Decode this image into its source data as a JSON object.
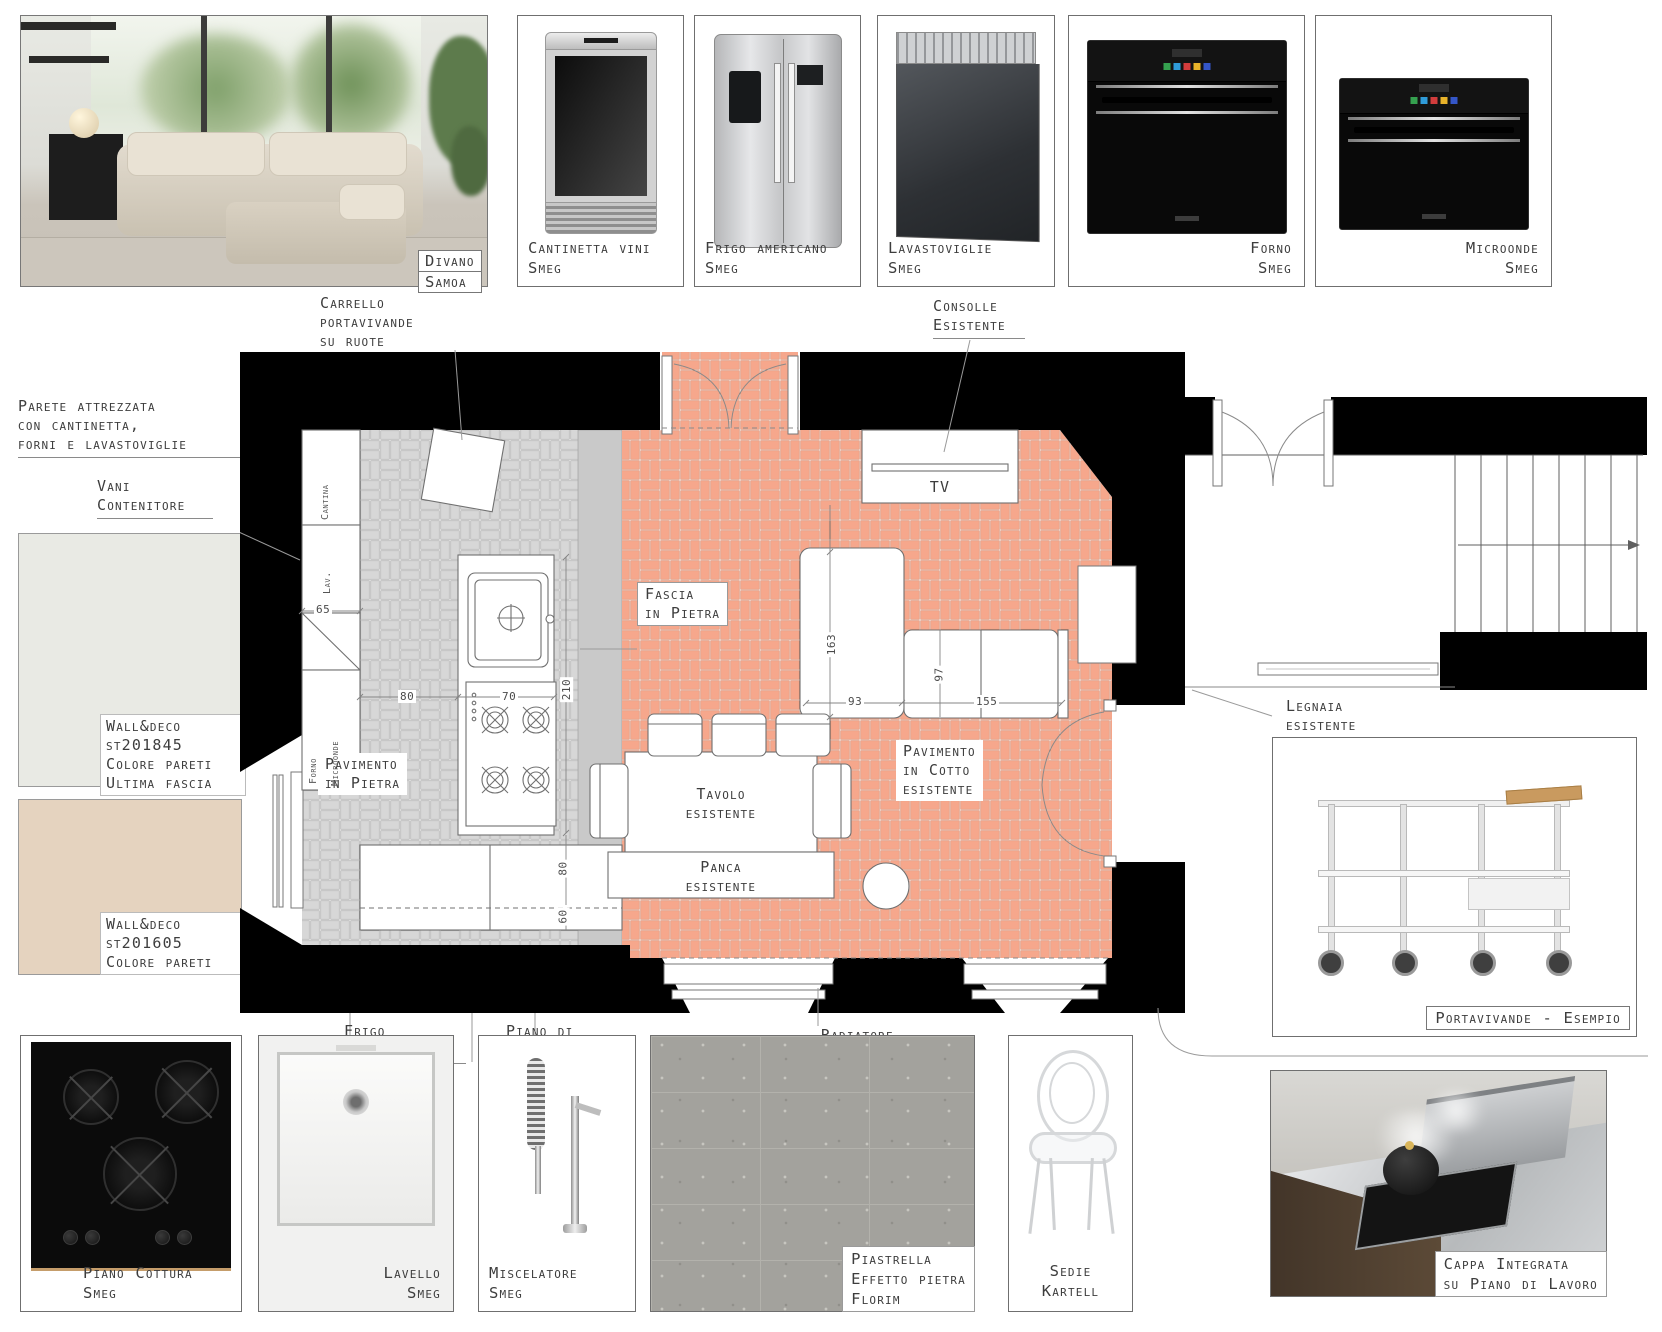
{
  "top_row": {
    "sofa_label": [
      "Divano",
      "Samoa"
    ],
    "products": [
      {
        "label": "Cantinetta vini",
        "brand": "Smeg"
      },
      {
        "label": "Frigo americano",
        "brand": "Smeg"
      },
      {
        "label": "Lavastoviglie",
        "brand": "Smeg"
      },
      {
        "label": "Forno",
        "brand": "Smeg"
      },
      {
        "label": "Microonde",
        "brand": "Smeg"
      }
    ]
  },
  "annotations": {
    "carrello": [
      "Carrello",
      "portavivande",
      "su ruote"
    ],
    "consolle": [
      "Consolle",
      "Esistente"
    ],
    "parete": [
      "Parete attrezzata",
      "con cantinetta,",
      "forni e lavastoviglie"
    ],
    "vani": [
      "Vani",
      "Contenitore"
    ],
    "legnaia": [
      "Legnaia",
      "esistente"
    ],
    "mensole": "Mensole",
    "frigo_americano": [
      "Frigo",
      "Americano"
    ],
    "piano_lavoro": [
      "Piano di",
      "lavoro con",
      "affettatrice"
    ],
    "radiatore": "Radiatore"
  },
  "swatches": [
    {
      "color": "#e9eae4",
      "lines": [
        "Wall&deco",
        "st201845",
        "Colore pareti",
        "Ultima fascia"
      ]
    },
    {
      "color": "#e5d3bf",
      "lines": [
        "Wall&deco",
        "st201605",
        "Colore pareti"
      ]
    }
  ],
  "plan": {
    "labels": {
      "tv": "TV",
      "fascia": [
        "Fascia",
        "in Pietra"
      ],
      "pavimento_pietra": [
        "Pavimento",
        "in Pietra"
      ],
      "pavimento_cotto": [
        "Pavimento",
        "in Cotto",
        "esistente"
      ],
      "tavolo": [
        "Tavolo",
        "esistente"
      ],
      "panca": [
        "Panca",
        "esistente"
      ]
    },
    "units": [
      "Cantina",
      "Lav.",
      "Forno",
      "Microonde"
    ],
    "dims": {
      "d65": "65",
      "d80": "80",
      "d70": "70",
      "d210": "210",
      "d163": "163",
      "d93": "93",
      "d97": "97",
      "d155": "155",
      "d80b": "80",
      "d60": "60"
    }
  },
  "portavivande": {
    "label": "Portavivande - Esempio"
  },
  "bottom_row": {
    "piano_cottura": [
      "Piano Cottura",
      "Smeg"
    ],
    "lavello": [
      "Lavello",
      "Smeg"
    ],
    "miscelatore": [
      "Miscelatore",
      "Smeg"
    ],
    "piastrella": [
      "Piastrella",
      "Effetto pietra",
      "Florim"
    ],
    "sedie": [
      "Sedie",
      "Kartell"
    ],
    "cappa": [
      "Cappa Integrata",
      "su Piano di Lavoro"
    ]
  },
  "colors": {
    "wall": "#000000",
    "cotto": "#f6a78c",
    "cotto_line": "#d88a6d",
    "stone": "#d7d7d7",
    "stone_line": "#a9a9a9",
    "fascia_strip": "#c9c9c9",
    "oven_buttons": [
      "#35a14f",
      "#2f9bd8",
      "#d23c3c",
      "#e9b32a",
      "#3456c8"
    ]
  }
}
